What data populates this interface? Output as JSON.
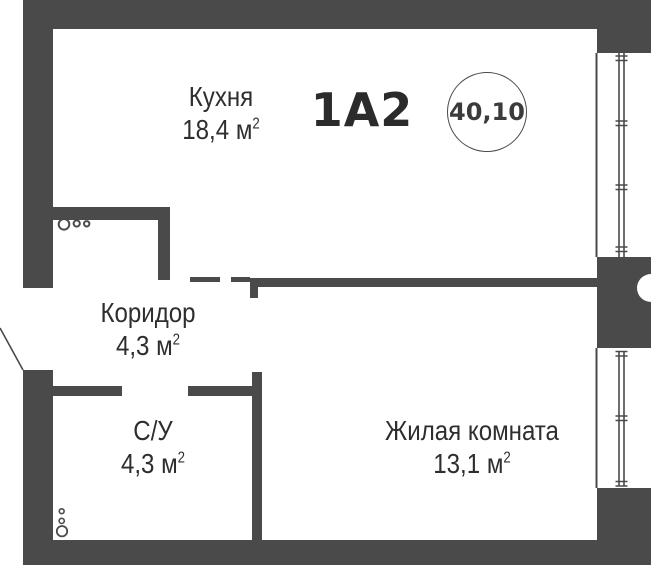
{
  "unit": {
    "code": "1А2",
    "total_area": "40,10"
  },
  "rooms": {
    "kitchen": {
      "name": "Кухня",
      "area": "18,4 м",
      "area_sup": "2"
    },
    "corridor": {
      "name": "Коридор",
      "area": "4,3 м",
      "area_sup": "2"
    },
    "bathroom": {
      "name": "С/У",
      "area": "4,3 м",
      "area_sup": "2"
    },
    "living": {
      "name": "Жилая комната",
      "area": "13,1 м",
      "area_sup": "2"
    }
  },
  "colors": {
    "wall": "#4a4a4a",
    "text": "#2e2e2e",
    "unit_code_text": "#2b2b2b",
    "background": "#ffffff"
  }
}
